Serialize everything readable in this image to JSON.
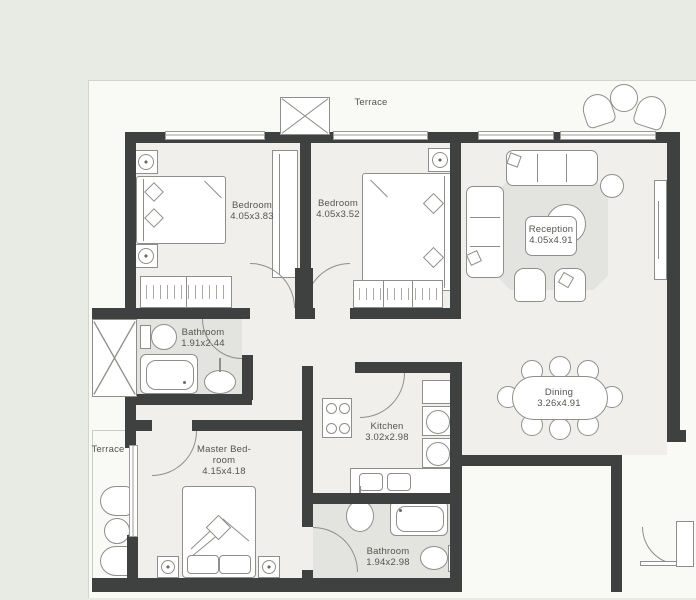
{
  "plan_title": "Apartment floor plan",
  "palette": {
    "outer": "#e8ebe4",
    "paper": "#f9f9f6",
    "floor": "#f0efec",
    "wet": "#e3e3df",
    "wall": "#3e4140",
    "line": "#8e8e8a",
    "text": "#55544f"
  },
  "rooms": [
    {
      "name": "Bedroom",
      "dims": "4.05x3.83"
    },
    {
      "name": "Bedroom",
      "dims": "4.05x3.52"
    },
    {
      "name": "Reception",
      "dims": "4.05x4.91"
    },
    {
      "name": "Bathroom",
      "dims": "1.91x2.44"
    },
    {
      "name": "Kitchen",
      "dims": "3.02x2.98"
    },
    {
      "name": "Dining",
      "dims": "3.26x4.91"
    },
    {
      "name_line1": "Master Bed-",
      "name_line2": "room",
      "dims": "4.15x4.18"
    },
    {
      "name": "Bathroom",
      "dims": "1.94x2.98"
    },
    {
      "name": "Terrace"
    },
    {
      "name": "Terrace"
    }
  ]
}
